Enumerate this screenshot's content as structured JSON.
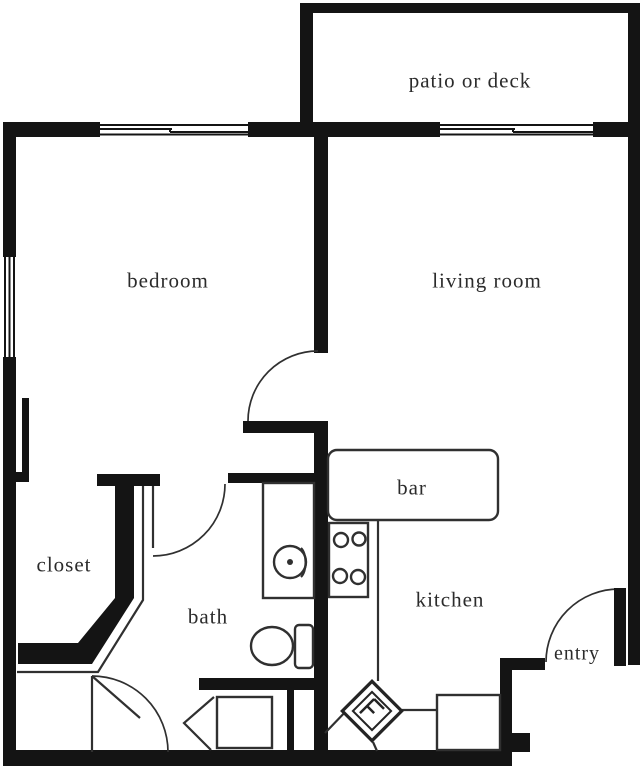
{
  "colors": {
    "bg": "#ffffff",
    "wall": "#141414",
    "line": "#303030",
    "text": "#2b2b2b"
  },
  "rooms": {
    "patio": {
      "label": "patio or deck"
    },
    "bedroom": {
      "label": "bedroom"
    },
    "living": {
      "label": "living room"
    },
    "closet": {
      "label": "closet"
    },
    "bar": {
      "label": "bar"
    },
    "bath": {
      "label": "bath"
    },
    "kitchen": {
      "label": "kitchen"
    },
    "entry": {
      "label": "entry"
    }
  }
}
